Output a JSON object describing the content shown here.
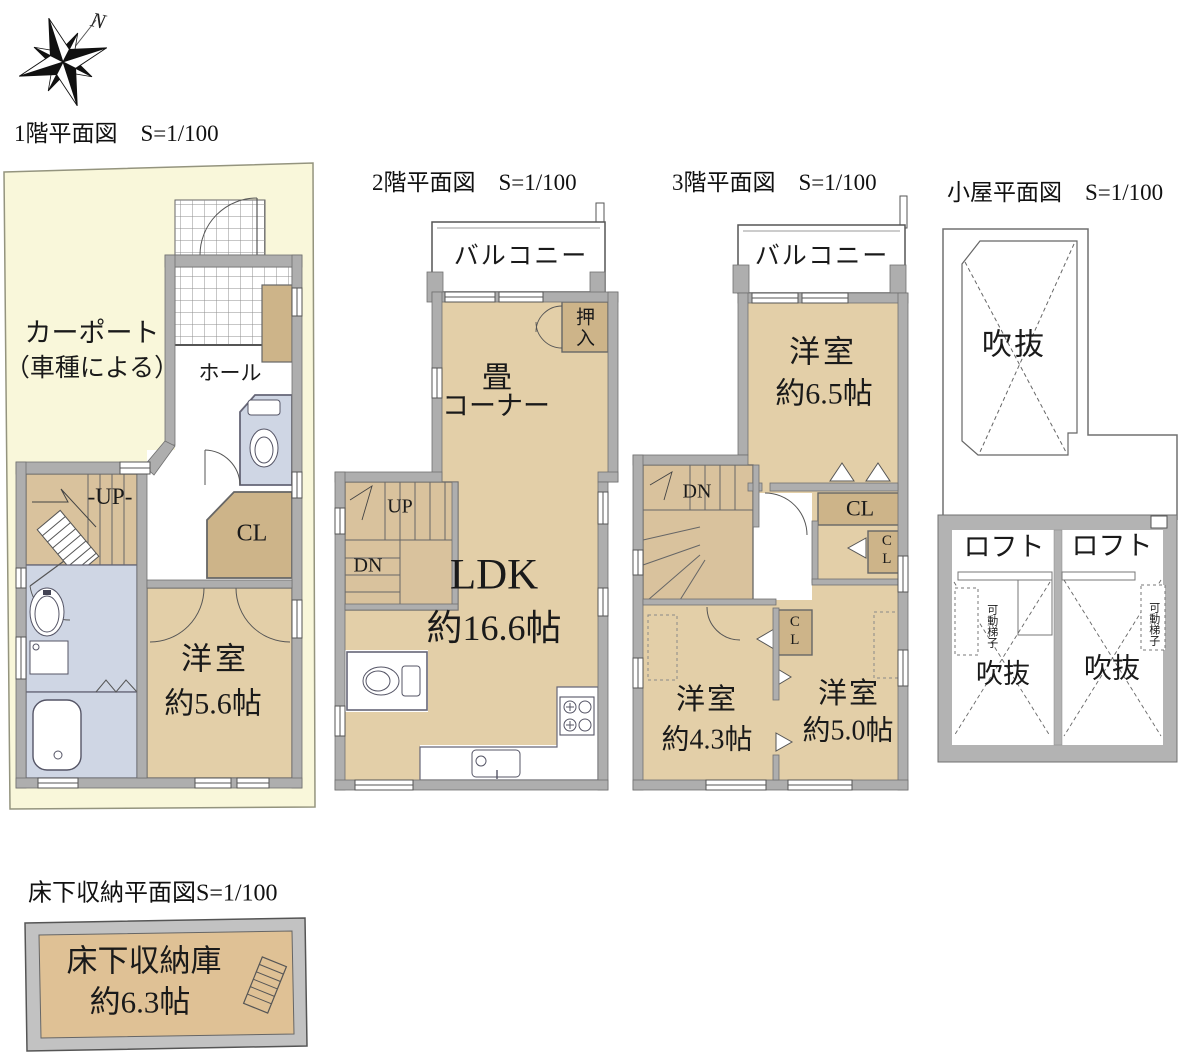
{
  "document": {
    "type": "floor-plan-sheet",
    "scale_note": "S=1/100"
  },
  "compass": {
    "label": "N"
  },
  "colors": {
    "room_tan": "#e3cfa8",
    "closet_tan": "#cdb489",
    "stairs_tan": "#d9c29d",
    "wet_blue": "#cfd6e4",
    "wall_gray": "#aeaeae",
    "site_yellow": "#f9f7da",
    "frame_gray": "#c2c2c2",
    "underfloor_tan": "#dfc195"
  },
  "plans": {
    "floor1": {
      "title": "1階平面図　S=1/100",
      "labels": {
        "carport_line1": "カーポート",
        "carport_line2": "（車種による）",
        "hall": "ホール",
        "up": "-UP-",
        "cl": "CL",
        "room_name": "洋室",
        "room_size": "約5.6帖"
      }
    },
    "floor2": {
      "title": "2階平面図　S=1/100",
      "labels": {
        "balcony": "バルコニー",
        "oshiire": "押入",
        "tatami_line1": "畳",
        "tatami_line2": "コーナー",
        "up": "UP",
        "dn": "DN",
        "ldk_name": "LDK",
        "ldk_size": "約16.6帖"
      }
    },
    "floor3": {
      "title": "3階平面図　S=1/100",
      "labels": {
        "balcony": "バルコニー",
        "room65_name": "洋室",
        "room65_size": "約6.5帖",
        "dn": "DN",
        "cl_top": "CL",
        "cl_right": "CL",
        "cl_mid": "CL",
        "room43_name": "洋室",
        "room43_size": "約4.3帖",
        "room50_name": "洋室",
        "room50_size": "約5.0帖"
      }
    },
    "attic": {
      "title": "小屋平面図　S=1/100",
      "labels": {
        "void_top": "吹抜",
        "loft_left": "ロフト",
        "loft_right": "ロフト",
        "ladder_left": "可動梯子",
        "ladder_right": "可動梯子",
        "void_left": "吹抜",
        "void_right": "吹抜"
      }
    },
    "underfloor": {
      "title": "床下収納平面図S=1/100",
      "labels": {
        "name": "床下収納庫",
        "size": "約6.3帖"
      }
    }
  }
}
